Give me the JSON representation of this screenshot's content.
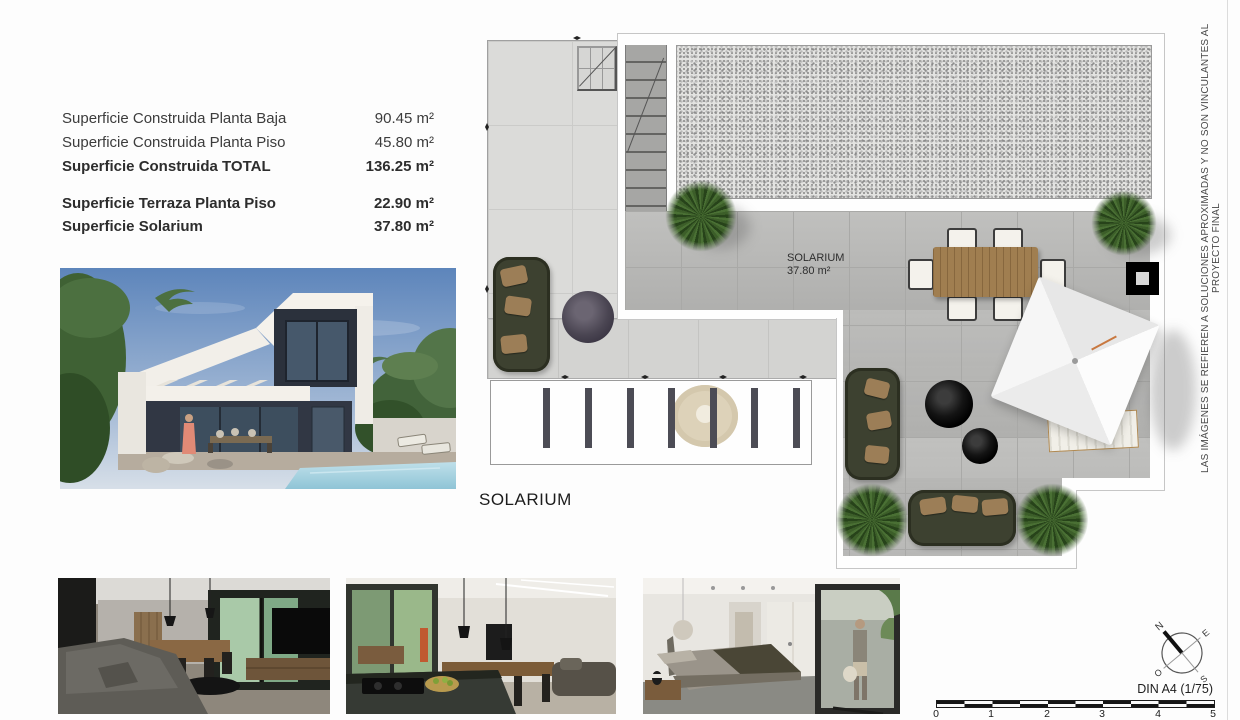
{
  "surface_table": {
    "rows": [
      {
        "label": "Superficie Construida Planta Baja",
        "value": "90.45 m²"
      },
      {
        "label": "Superficie Construida Planta Piso",
        "value": "45.80 m²"
      },
      {
        "label": "Superficie Construida TOTAL",
        "value": "136.25 m²"
      },
      {
        "label": "Superficie Terraza Planta Piso",
        "value": "22.90 m²"
      },
      {
        "label": "Superficie Solarium",
        "value": "37.80 m²"
      }
    ]
  },
  "plan": {
    "caption": "SOLARIUM",
    "room_label": {
      "name": "SOLARIUM",
      "area": "37.80 m²"
    }
  },
  "disclaimer": "LAS IMÁGENES SE REFIEREN A SOLUCIONES APROXIMADAS Y NO SON VINCULANTES AL PROYECTO FINAL",
  "compass": {
    "n": "N",
    "e": "E",
    "s": "S",
    "w": "O"
  },
  "scale_bar": {
    "label": "DIN A4 (1/75)",
    "ticks": [
      "0",
      "1",
      "2",
      "3",
      "4",
      "5"
    ]
  },
  "colors": {
    "solarium_tile": "#b9b9b7",
    "terrace_tile": "#dbdbd9",
    "gravel": "#e3e3e1",
    "sofa_olive": "#3d4130",
    "cushion_tan": "#9c7e57",
    "pouf_black": "#141414",
    "plant_green": "#27431a",
    "table_wood": "#a07e50",
    "parasol_white": "#f6f6f6",
    "sky_blue": "#5d85bb",
    "pool_blue": "#9cc9da"
  }
}
